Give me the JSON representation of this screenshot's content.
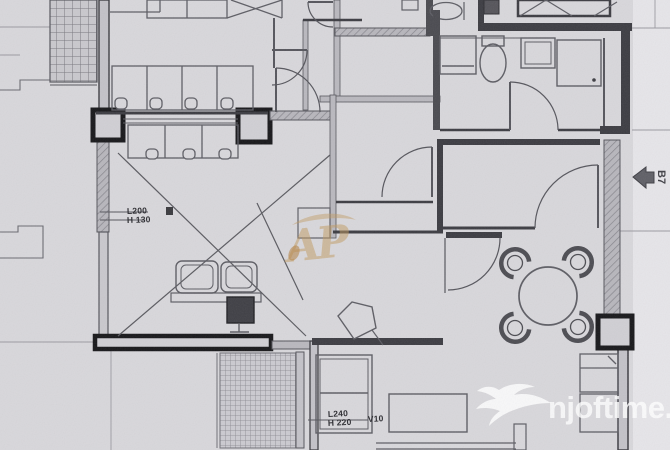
{
  "labels": {
    "window": {
      "l": "L200",
      "h": "H 130"
    },
    "balcony_door": {
      "l": "L240",
      "h": "H 220",
      "v": "V10"
    },
    "unit": "B7"
  },
  "watermarks": {
    "center_logo": "AP",
    "site": "njoftime.al"
  },
  "colors": {
    "paper": "#d8d7db",
    "paper_margin": "#e6e5e9",
    "wall_dark": "#3c3c42",
    "wall_black": "#17171a",
    "line": "#55555c",
    "gold": "#c19a5f",
    "watermark_white": "#ffffff"
  }
}
